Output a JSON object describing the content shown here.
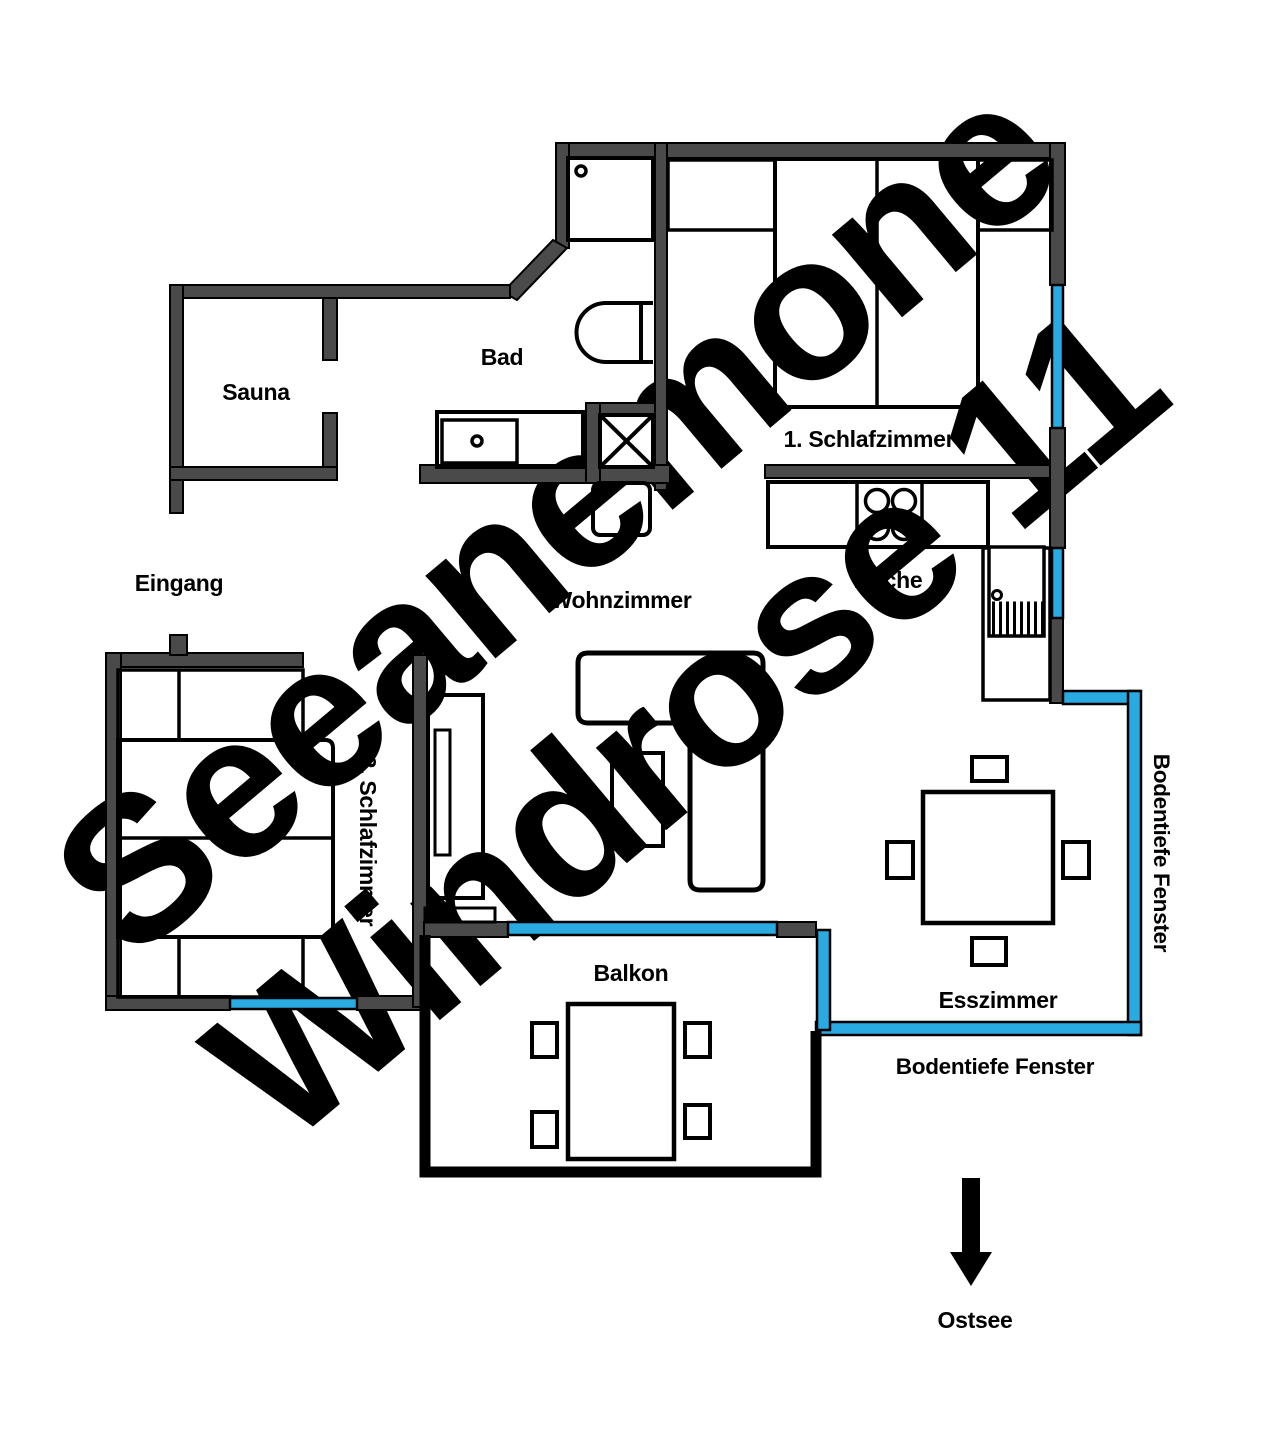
{
  "colors": {
    "wall": "#4a4a4a",
    "window": "#29abe2",
    "outline": "#000000",
    "watermark": "#d9d9d9"
  },
  "rooms": {
    "sauna": {
      "label": "Sauna"
    },
    "bad": {
      "label": "Bad"
    },
    "eingang": {
      "label": "Eingang"
    },
    "schlafzimmer1": {
      "label": "1. Schlafzimmer"
    },
    "kueche": {
      "label": "Küche"
    },
    "wohnzimmer": {
      "label": "Wohnzimmer"
    },
    "schlafzimmer2": {
      "label": "2. Schlafzimmer"
    },
    "esszimmer": {
      "label": "Esszimmer"
    },
    "balkon": {
      "label": "Balkon"
    }
  },
  "windows": {
    "label_right": "Bodentiefe Fenster",
    "label_bottom": "Bodentiefe Fenster"
  },
  "compass": {
    "label": "Ostsee"
  },
  "watermark": {
    "line1": "Seeanemone",
    "line2": "Windrose 11"
  }
}
